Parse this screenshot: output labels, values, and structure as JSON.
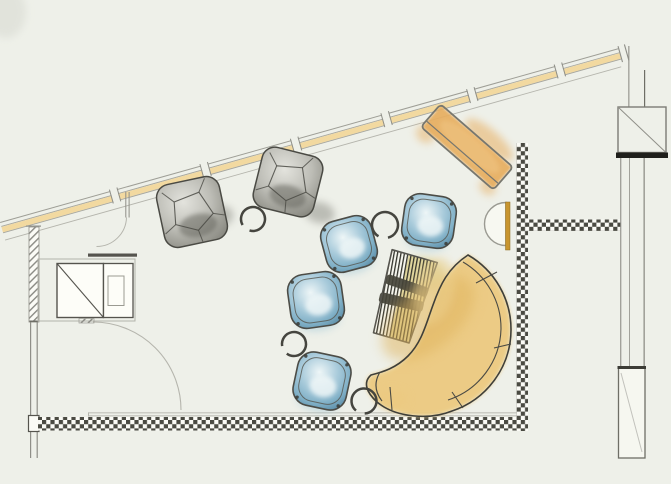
{
  "meta": {
    "width": 671,
    "height": 484,
    "background": "#eef0e9",
    "description": "hand-sketched lounge floor plan, watercolor furniture"
  },
  "palette": {
    "background": "#eef0e9",
    "paper_white": "#fbfbf6",
    "line_light": "#b5b5ad",
    "line_mid": "#8f8f88",
    "line_soft": "#a6a69e",
    "line_dark": "#55544e",
    "ink": "#3f3f39",
    "black": "#1f1f1b",
    "window_band": "#f2d9a0",
    "checker": "#4a4a42",
    "hatch": "#8a8a84",
    "gold_bar": "#c8952f",
    "bench_orange": "#e7ae61",
    "bench_orange_light": "#edc07c",
    "sofa_yellow": "#ecca80",
    "sofa_yellow_deep": "#dfb35c",
    "sofa_spill": "#ecd08e",
    "chair_blue_light": "#eef6f7",
    "chair_blue": "#a9cbdb",
    "chair_blue_mid": "#7fafc6",
    "chair_blue_deep": "#5e8fa9",
    "chair_bleed": "#9fc6d6",
    "pouf_light": "#e3e3dd",
    "pouf_mid": "#bdbdb6",
    "pouf_dark": "#8a8a82",
    "pouf_shadow": "#6f6f68",
    "lounger_tint": "#cdbd5e",
    "lounger_bar": "#45443a",
    "lounger_paper": "#f6f5ee"
  },
  "architecture": {
    "corner_smudge": {
      "cx": 6,
      "cy": 12,
      "rx": 20,
      "ry": 26
    },
    "window_band": {
      "x": 0,
      "y": 222,
      "angle": -15.7,
      "length": 654,
      "ticks": [
        118,
        212,
        306,
        400,
        489,
        580
      ],
      "cap": 642
    },
    "left_wall": {
      "hatch": {
        "x": 29,
        "y": 227,
        "w": 10,
        "h": 95
      },
      "cap": {
        "x": 26,
        "y": 225.5,
        "w": 15,
        "h": 1.2
      },
      "line1_x": 30,
      "line2_x": 36.6,
      "lines_y1": 322,
      "lines_y2": 458,
      "top_tick": {
        "x": 29.5,
        "y": 320.5,
        "w": 8.5,
        "h": 1.6
      },
      "junction": {
        "x": 28.5,
        "y": 415.5,
        "w": 10.5,
        "h": 16
      }
    },
    "bottom_wall": {
      "checker": {
        "x": 38,
        "y": 417,
        "w": 485,
        "h": 13.5
      },
      "face_x1": 88,
      "face_x2": 523,
      "face_y1": 412.4,
      "face_y2": 415.4
    },
    "partition": {
      "vertical": {
        "x": 516.5,
        "y": 143,
        "w": 11.5,
        "h": 288
      },
      "horizontal": {
        "x": 528,
        "y": 219.5,
        "w": 93,
        "h": 11.5
      }
    },
    "right_wall": {
      "l1": {
        "x": 628.3,
        "y1": 46,
        "y2": 107
      },
      "l2": {
        "x": 644,
        "y1": 70,
        "y2": 107
      },
      "column": {
        "x": 618,
        "y": 107,
        "w": 48,
        "h": 45.5
      },
      "bar": {
        "x": 616,
        "y": 152.5,
        "w": 52,
        "h": 5.5
      },
      "mid": [
        {
          "x": 620.2,
          "w": 1.1
        },
        {
          "x": 629,
          "w": 0.8
        },
        {
          "x": 643.5,
          "w": 1.3
        }
      ],
      "mid_y1": 158,
      "mid_y2": 368,
      "jamb": {
        "x": 618.5,
        "y": 368,
        "w": 26.5,
        "h": 90
      },
      "jamb_top": {
        "x": 617.5,
        "y": 366,
        "w": 28.5,
        "h": 3
      },
      "jamb_diag": "M621,373 L642,452"
    },
    "entry_door": {
      "cx": 93,
      "cy": 410,
      "r": 88
    },
    "upper_door": {
      "leaf_x1": 125.3,
      "leaf_x2": 128.6,
      "leaf_y1": 192,
      "leaf_y2": 217.5,
      "arc": "M126.5,217.5 A30,30 0 0 1 96.5,246.5"
    },
    "cabinet": {
      "outer": {
        "x": 38,
        "y": 259,
        "w": 97,
        "h": 62
      },
      "square": {
        "x": 57,
        "y": 263.5,
        "w": 46.5,
        "h": 54
      },
      "right": {
        "x": 103.5,
        "y": 263.5,
        "w": 29.5,
        "h": 54
      },
      "inner": {
        "x": 108,
        "y": 276,
        "w": 16,
        "h": 29.5
      },
      "top_bar": {
        "x": 88,
        "y": 253.5,
        "w": 49,
        "h": 3.2
      },
      "tick": {
        "x": 79,
        "y": 318.5,
        "w": 15,
        "h": 4.5
      }
    }
  },
  "furniture": {
    "bench": {
      "cx": 467,
      "cy": 147,
      "len": 96,
      "wid": 30,
      "rot": 41
    },
    "console": {
      "cx": 506,
      "cy": 224,
      "r": 21.5,
      "bar": {
        "x": 505.5,
        "y": 202,
        "w": 4.5,
        "h": 48
      }
    },
    "poufs": [
      {
        "cx": 192,
        "cy": 212,
        "r": 32,
        "rot": -12,
        "smudge": [
          24,
          10
        ]
      },
      {
        "cx": 288,
        "cy": 182,
        "r": 31,
        "rot": 14,
        "smudge": [
          38,
          22
        ]
      }
    ],
    "chairs": [
      {
        "cx": 349,
        "cy": 244,
        "r": 26,
        "rot": -15
      },
      {
        "cx": 429,
        "cy": 221,
        "r": 26,
        "rot": 8
      },
      {
        "cx": 316,
        "cy": 300,
        "r": 27,
        "rot": -8
      },
      {
        "cx": 322,
        "cy": 381,
        "r": 27,
        "rot": 12
      }
    ],
    "tables": [
      {
        "cx": 253,
        "cy": 219,
        "r": 12,
        "gap": 150
      },
      {
        "cx": 385,
        "cy": 225,
        "r": 13,
        "gap": 120
      },
      {
        "cx": 294,
        "cy": 344,
        "r": 12,
        "gap": 170
      },
      {
        "cx": 364,
        "cy": 401,
        "r": 12.5,
        "gap": 130
      }
    ],
    "lounger": {
      "cx": 403,
      "cy": 297,
      "rot": 16,
      "top_w": 47,
      "bot_w": 37,
      "h": 85
    },
    "sofa": {
      "outline": "M468,255 A86,86 0 0 1 511,330 A86,86 0 0 1 452,411 C430,420 396,418 377,402 C366,392 363,382 371,375 C383,372 396,368 408,356 C422,342 426,324 433,305 C440,285 448,268 468,255 Z",
      "back_line": "M463,262 A77,77 0 0 1 501,329 A77,77 0 0 1 448,400",
      "divisions": [
        "M476,283 L497,272",
        "M494,348 L511,344",
        "M452,392 L463,408",
        "M390,387 L392,410"
      ],
      "arm_line": "M380,372 C374,382 375,392 382,401"
    }
  }
}
